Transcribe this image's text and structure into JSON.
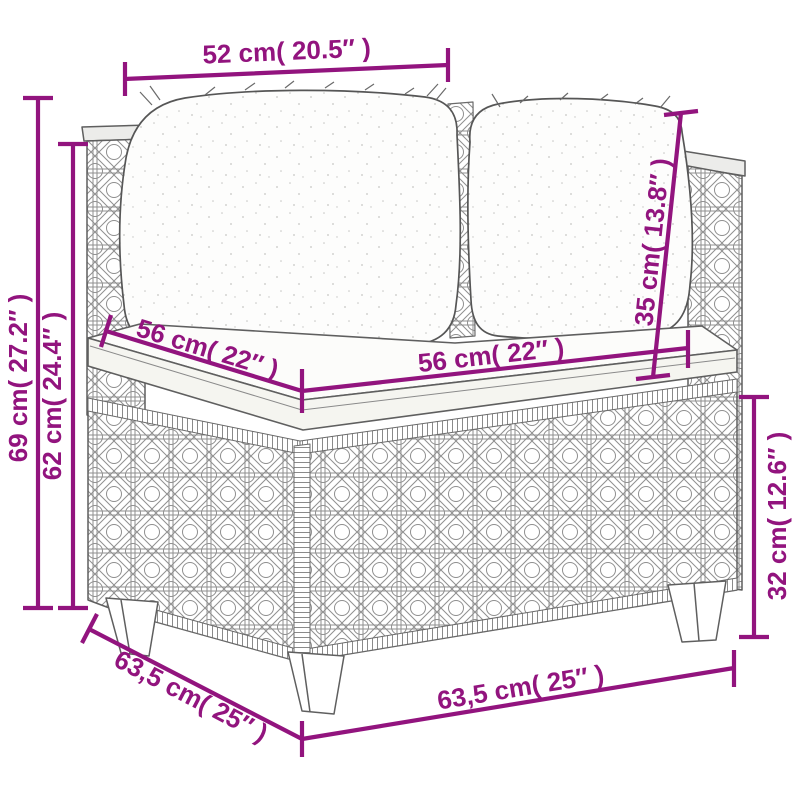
{
  "image_type": "furniture dimension diagram",
  "subject": "rattan corner sofa section with cushions",
  "colors": {
    "dimension_accent": "#92147e",
    "line_art": "#5f5f5f",
    "background": "#ffffff"
  },
  "dims": {
    "back_width": "52 cm( 20.5″ )",
    "overall_height": "69 cm( 27.2″ )",
    "back_height": "62 cm( 24.4″ )",
    "seat_depth": "56 cm( 22″ )",
    "seat_width": "56 cm( 22″ )",
    "backrest_height": "35 cm( 13.8″ )",
    "base_height": "32 cm( 12.6″ )",
    "overall_depth": "63,5 cm( 25″ )",
    "overall_width": "63,5 cm( 25″ )"
  }
}
